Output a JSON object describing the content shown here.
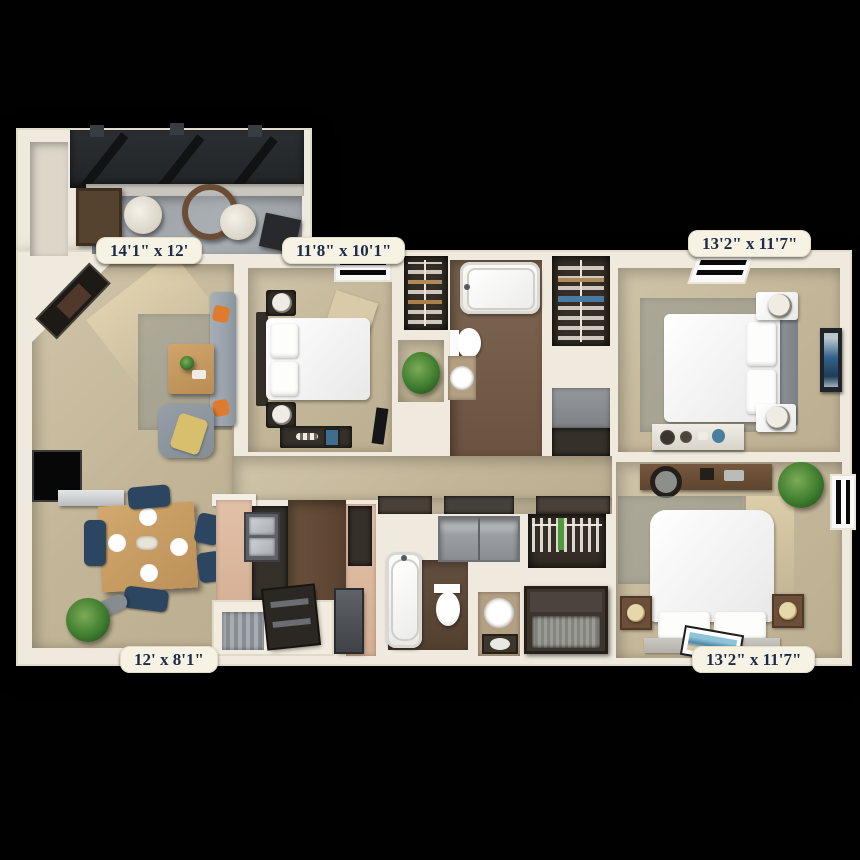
{
  "scene": {
    "kind": "3d-top-down-floor-plan",
    "background_color": "#010101"
  },
  "dimension_labels": [
    {
      "id": "patio",
      "text": "14'1\" x 12'"
    },
    {
      "id": "bedroom-top-middle",
      "text": "11'8\" x 10'1\""
    },
    {
      "id": "bedroom-top-right",
      "text": "13'2\" x 11'7\""
    },
    {
      "id": "dining-living",
      "text": "12' x 8'1\""
    },
    {
      "id": "bedroom-bottom-right",
      "text": "13'2\" x 11'7\""
    }
  ],
  "colors": {
    "wall_cream": "#efeadd",
    "carpet_tan": "#c8bb9f",
    "wood_floor": "#72593f",
    "patio_concrete": "#a0a5aa",
    "pergola_roof": "#26292d",
    "label_background": "#f6f2e4",
    "label_text": "#1c2b47",
    "counter_peach": "#dcb49b",
    "chair_navy": "#2c4560",
    "sofa_gray": "#99a2aa",
    "pillow_orange": "#df7b2c",
    "throw_yellow": "#d8bf6d",
    "plant_green": "#3f7d2f",
    "art_blue": "#3f7196"
  }
}
